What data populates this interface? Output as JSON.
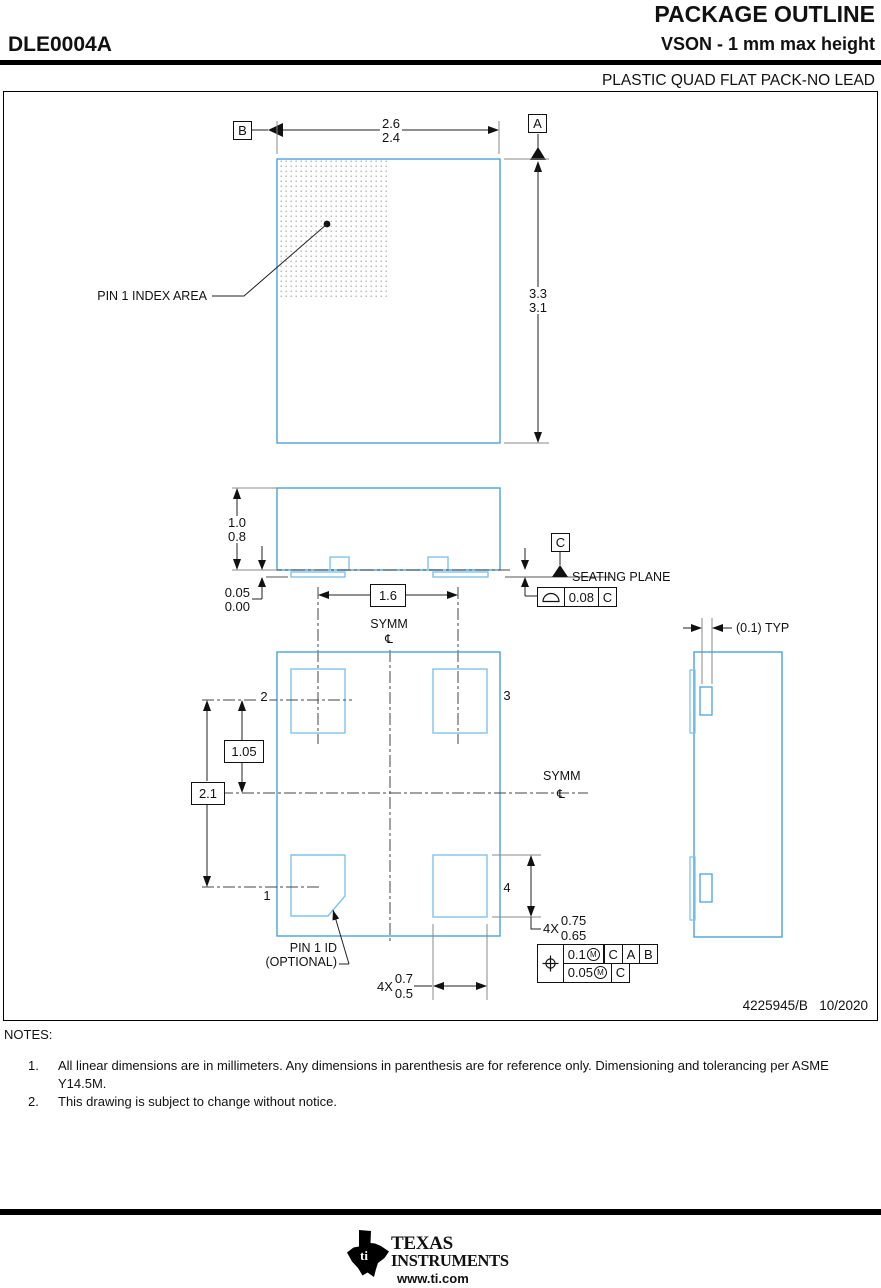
{
  "header": {
    "title": "PACKAGE OUTLINE",
    "part_number": "DLE0004A",
    "subtitle": "VSON - 1 mm max height",
    "package_type": "PLASTIC QUAD FLAT PACK-NO LEAD"
  },
  "top_view": {
    "datum_a": "A",
    "datum_b": "B",
    "dim_width": {
      "max": "2.6",
      "min": "2.4"
    },
    "dim_height": {
      "max": "3.3",
      "min": "3.1"
    },
    "pin1_index_label": "PIN 1 INDEX AREA"
  },
  "side_view": {
    "dim_height": {
      "max": "1.0",
      "min": "0.8"
    },
    "dim_standoff": {
      "max": "0.05",
      "min": "0.00"
    },
    "datum_c": "C",
    "seating_plane": "SEATING PLANE",
    "flatness": {
      "value": "0.08",
      "datum": "C"
    },
    "dim_pitch": "1.6",
    "symm": "SYMM",
    "centerline": "℄"
  },
  "bottom_view": {
    "pin1": "1",
    "pin2": "2",
    "pin3": "3",
    "pin4": "4",
    "dim_row": "1.05",
    "dim_span": "2.1",
    "symm": "SYMM",
    "centerline": "℄",
    "pad_length": {
      "qty": "4X",
      "max": "0.75",
      "min": "0.65"
    },
    "pad_width": {
      "qty": "4X",
      "max": "0.7",
      "min": "0.5"
    },
    "pin1_id": {
      "line1": "PIN 1 ID",
      "line2": "(OPTIONAL)"
    },
    "position": {
      "tol1": "0.1",
      "mod1": "M",
      "d1a": "C",
      "d1b": "A",
      "d1c": "B",
      "tol2": "0.05",
      "mod2": "M",
      "d2a": "C"
    }
  },
  "detail": {
    "typ": "(0.1) TYP"
  },
  "title_block": {
    "drawing_number": "4225945/B   10/2020"
  },
  "notes": {
    "heading": "NOTES:",
    "n1_num": "1.",
    "n1_text": "All linear dimensions are in millimeters. Any dimensions in parenthesis are for reference only. Dimensioning and tolerancing per ASME Y14.5M.",
    "n2_num": "2.",
    "n2_text": "This drawing is subject to change without notice."
  },
  "footer": {
    "brand1": "TEXAS",
    "brand2": "INSTRUMENTS",
    "url": "www.ti.com",
    "ti_mark": "ti"
  },
  "colors": {
    "outline_blue": "#4aa3dd",
    "pad_blue": "#7fc3ec"
  }
}
